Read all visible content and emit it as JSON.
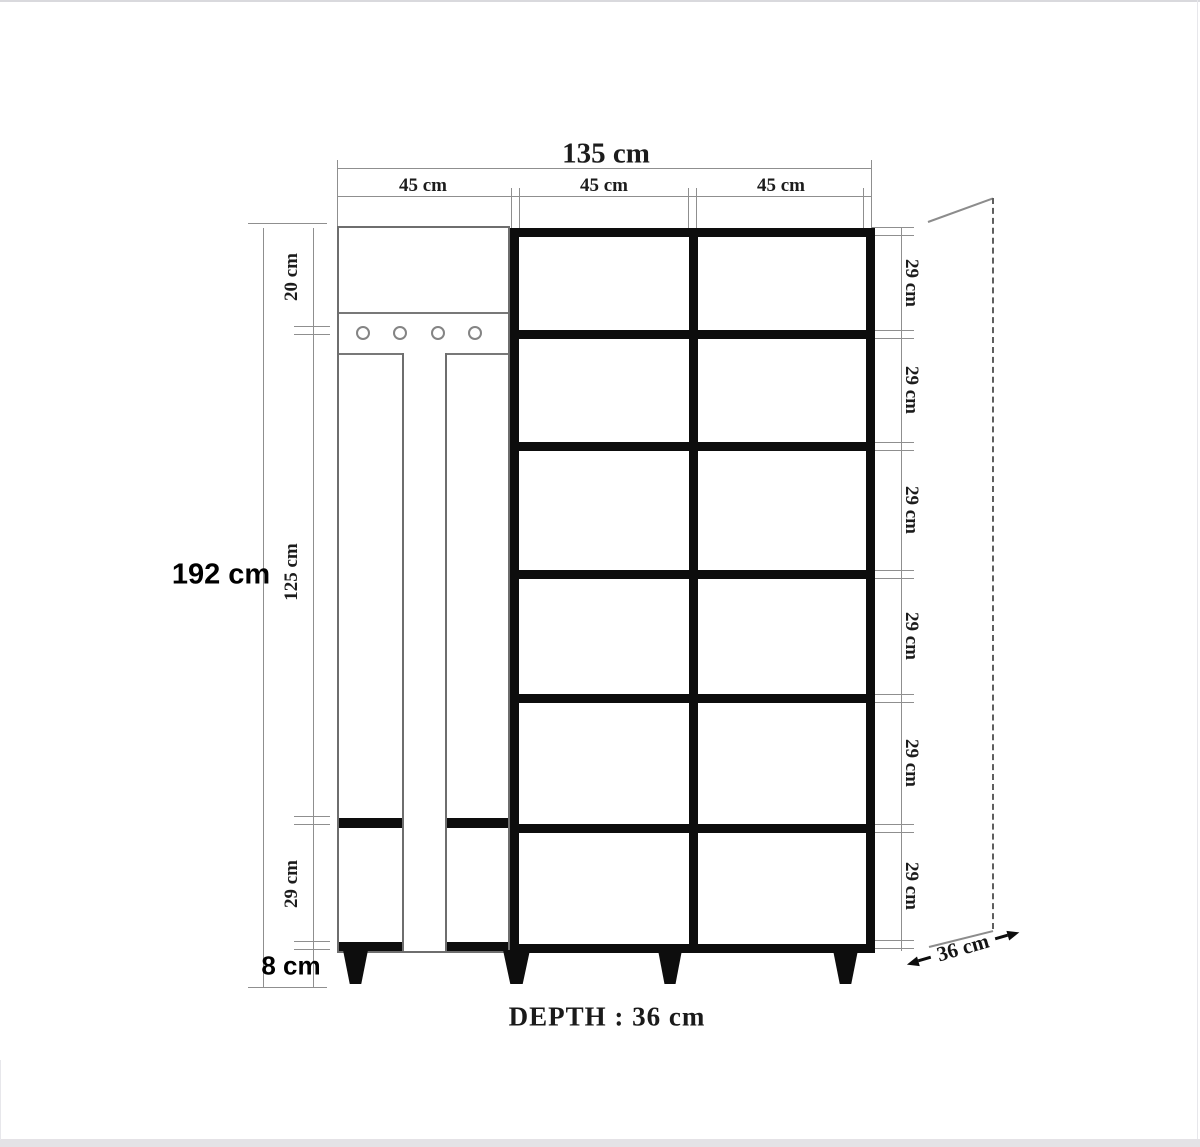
{
  "diagram": {
    "type": "furniture-dimension-drawing",
    "total_width_label": "135 cm",
    "section_width_labels": [
      "45 cm",
      "45 cm",
      "45 cm"
    ],
    "overall_height_label": "192 cm",
    "left_segments": {
      "top_panel": "20 cm",
      "mirror_panel": "125 cm",
      "bottom_cabinet": "29 cm",
      "legs": "8 cm"
    },
    "right_row_labels": [
      "29 cm",
      "29 cm",
      "29 cm",
      "29 cm",
      "29 cm",
      "29 cm"
    ],
    "depth_caption": "DEPTH : 36 cm",
    "depth_dimension_label": "36 cm",
    "hooks_count": 4,
    "colors": {
      "outline_thick": "#0d0d0d",
      "outline_thin": "#6e6e6e",
      "dimension_line": "#8f8f8f",
      "text": "#1c1c1c",
      "page_edge": "#e4e2e6"
    }
  }
}
